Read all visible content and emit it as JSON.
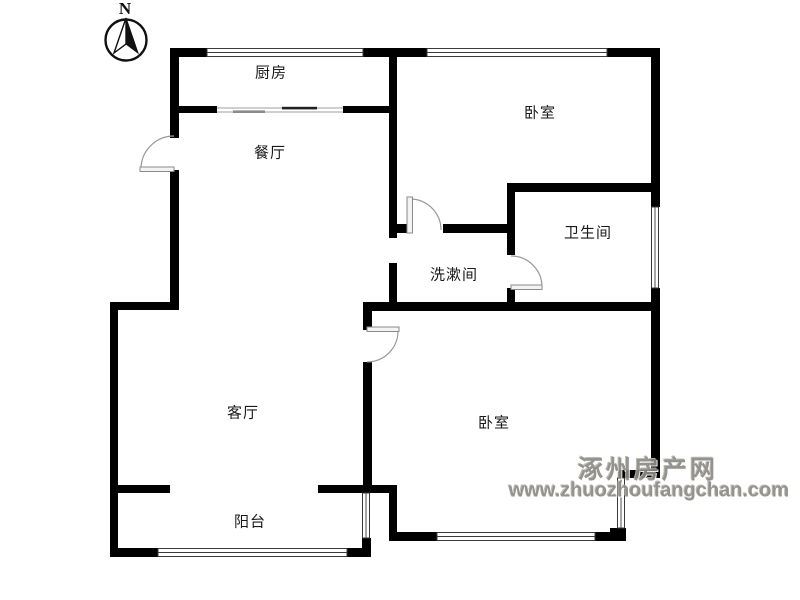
{
  "compass": {
    "label": "N"
  },
  "rooms": [
    {
      "id": "kitchen",
      "label": "厨房"
    },
    {
      "id": "dining-room",
      "label": "餐厅"
    },
    {
      "id": "bedroom-north",
      "label": "卧室"
    },
    {
      "id": "bathroom",
      "label": "卫生间"
    },
    {
      "id": "washroom",
      "label": "洗漱间"
    },
    {
      "id": "living-room",
      "label": "客厅"
    },
    {
      "id": "bedroom-south",
      "label": "卧室"
    },
    {
      "id": "balcony",
      "label": "阳台"
    }
  ],
  "watermark": {
    "site_name": "涿州房产网",
    "site_url": "www.zhuozhoufangchan.com"
  },
  "colors": {
    "wall": "#000000",
    "window_frame": "#3a3a3a",
    "door": "#9a9a9a",
    "label_text": "#1a1a1a",
    "watermark": "#8d8a85",
    "background": "#ffffff"
  }
}
